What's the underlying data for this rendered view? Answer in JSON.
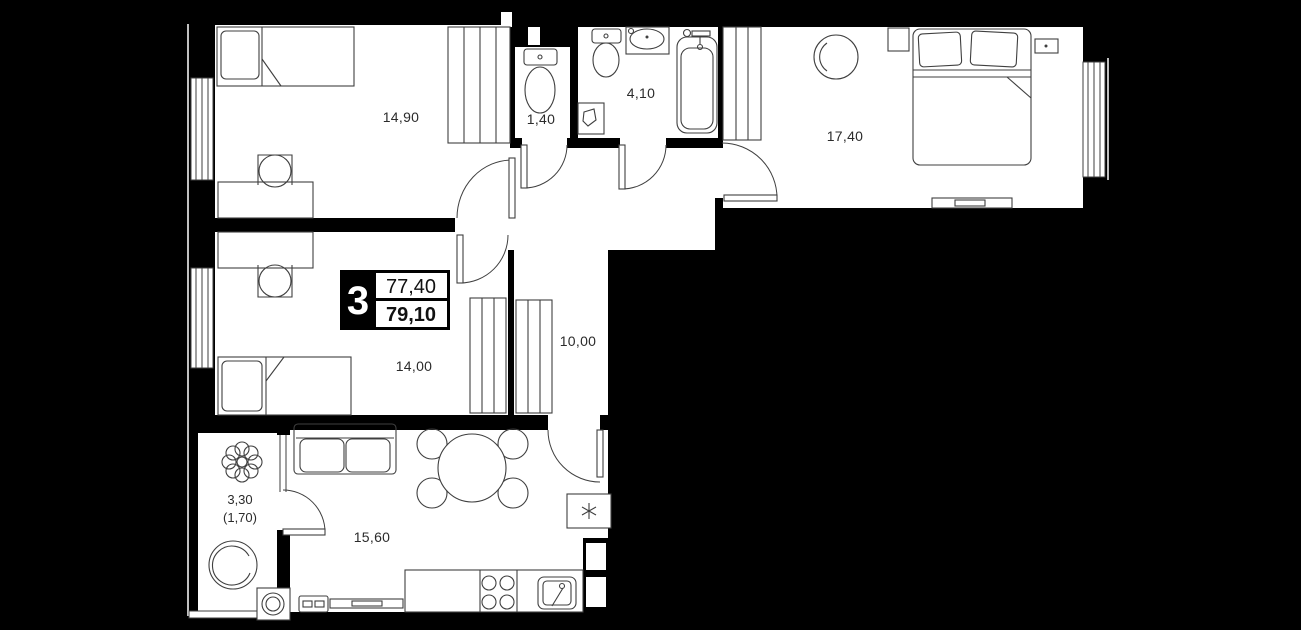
{
  "floor_plan": {
    "unit_badge": {
      "rooms_count": "3",
      "area_top": "77,40",
      "area_bottom": "79,10"
    },
    "room_labels": {
      "bedroom_top_left": "14,90",
      "wc": "1,40",
      "bathroom": "4,10",
      "bedroom_top_right": "17,40",
      "hallway": "10,00",
      "bedroom_middle": "14,00",
      "kitchen_living": "15,60",
      "balcony_area": "3,30",
      "balcony_area_reduced": "(1,70)"
    },
    "colors": {
      "background": "#000000",
      "floor": "#ffffff",
      "wall": "#000000",
      "line": "#3f3f3f",
      "badge_bg": "#000000",
      "badge_text": "#ffffff"
    }
  }
}
